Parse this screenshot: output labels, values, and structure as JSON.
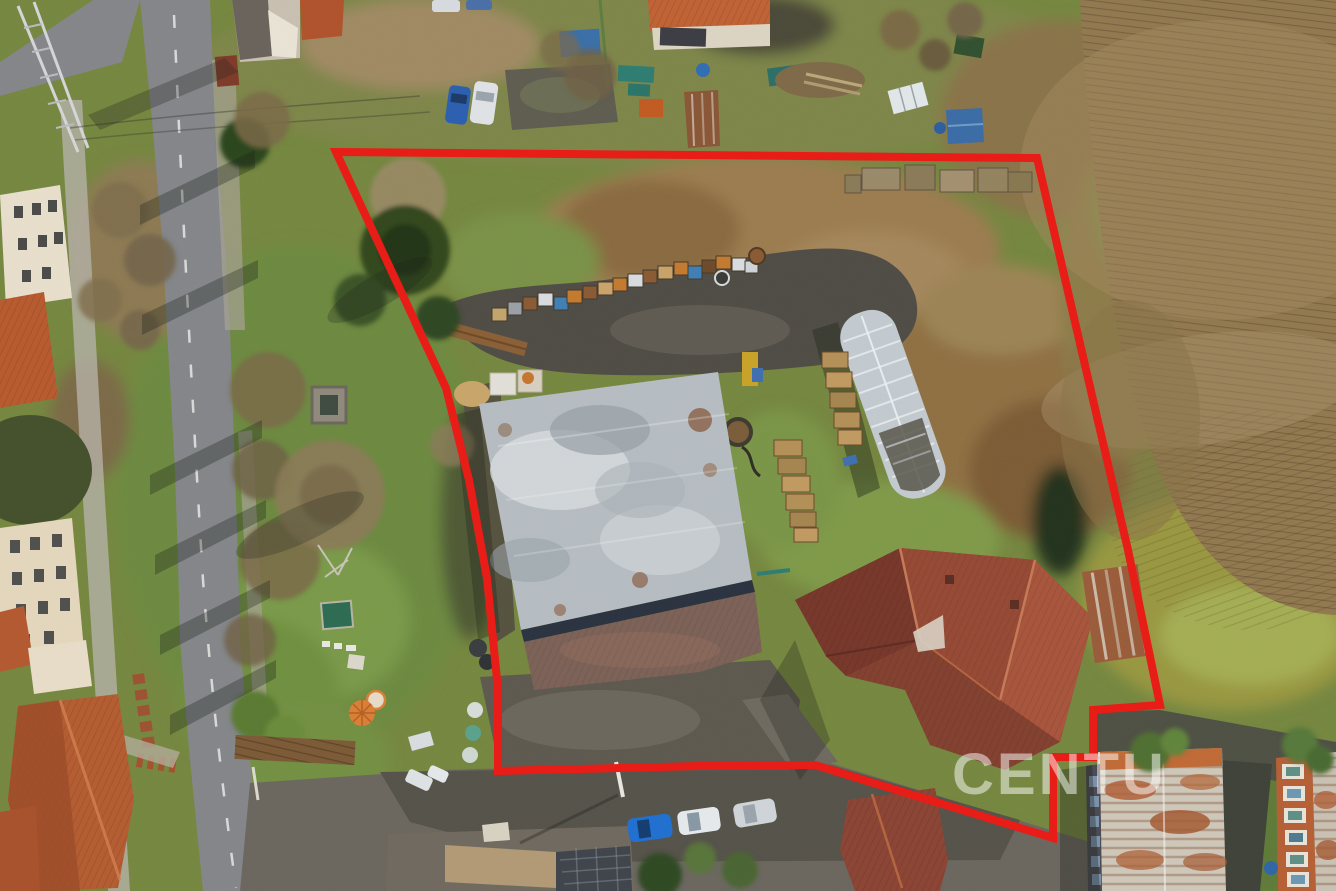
{
  "meta": {
    "kind": "aerial-drone-photograph",
    "width": 1336,
    "height": 891
  },
  "watermark": {
    "text": "CENTU",
    "color": "#ffffff",
    "opacity": "0.5"
  },
  "boundary": {
    "label": "property-boundary-outline",
    "color": "#e81d17",
    "stroke_width": "8",
    "points": "336,152 1037,158 1097,417 1128,550 1160,705 1093,710 1093,757 1053,757 1053,838 815,765 700,766 498,771 498,690 487,578 469,480 446,388"
  },
  "palette": {
    "grass_base": "#75873f",
    "field_brown": "#91784f",
    "asphalt": "#84868a",
    "dark_yard": "#4f4c45",
    "barn_roof_gray": "#b6bdc2",
    "house_roof_red": "#83402f",
    "rowhouse_roof_orange": "#b85a2e",
    "greenhouse_white": "#c3cad0",
    "boundary_red": "#e81d17"
  }
}
